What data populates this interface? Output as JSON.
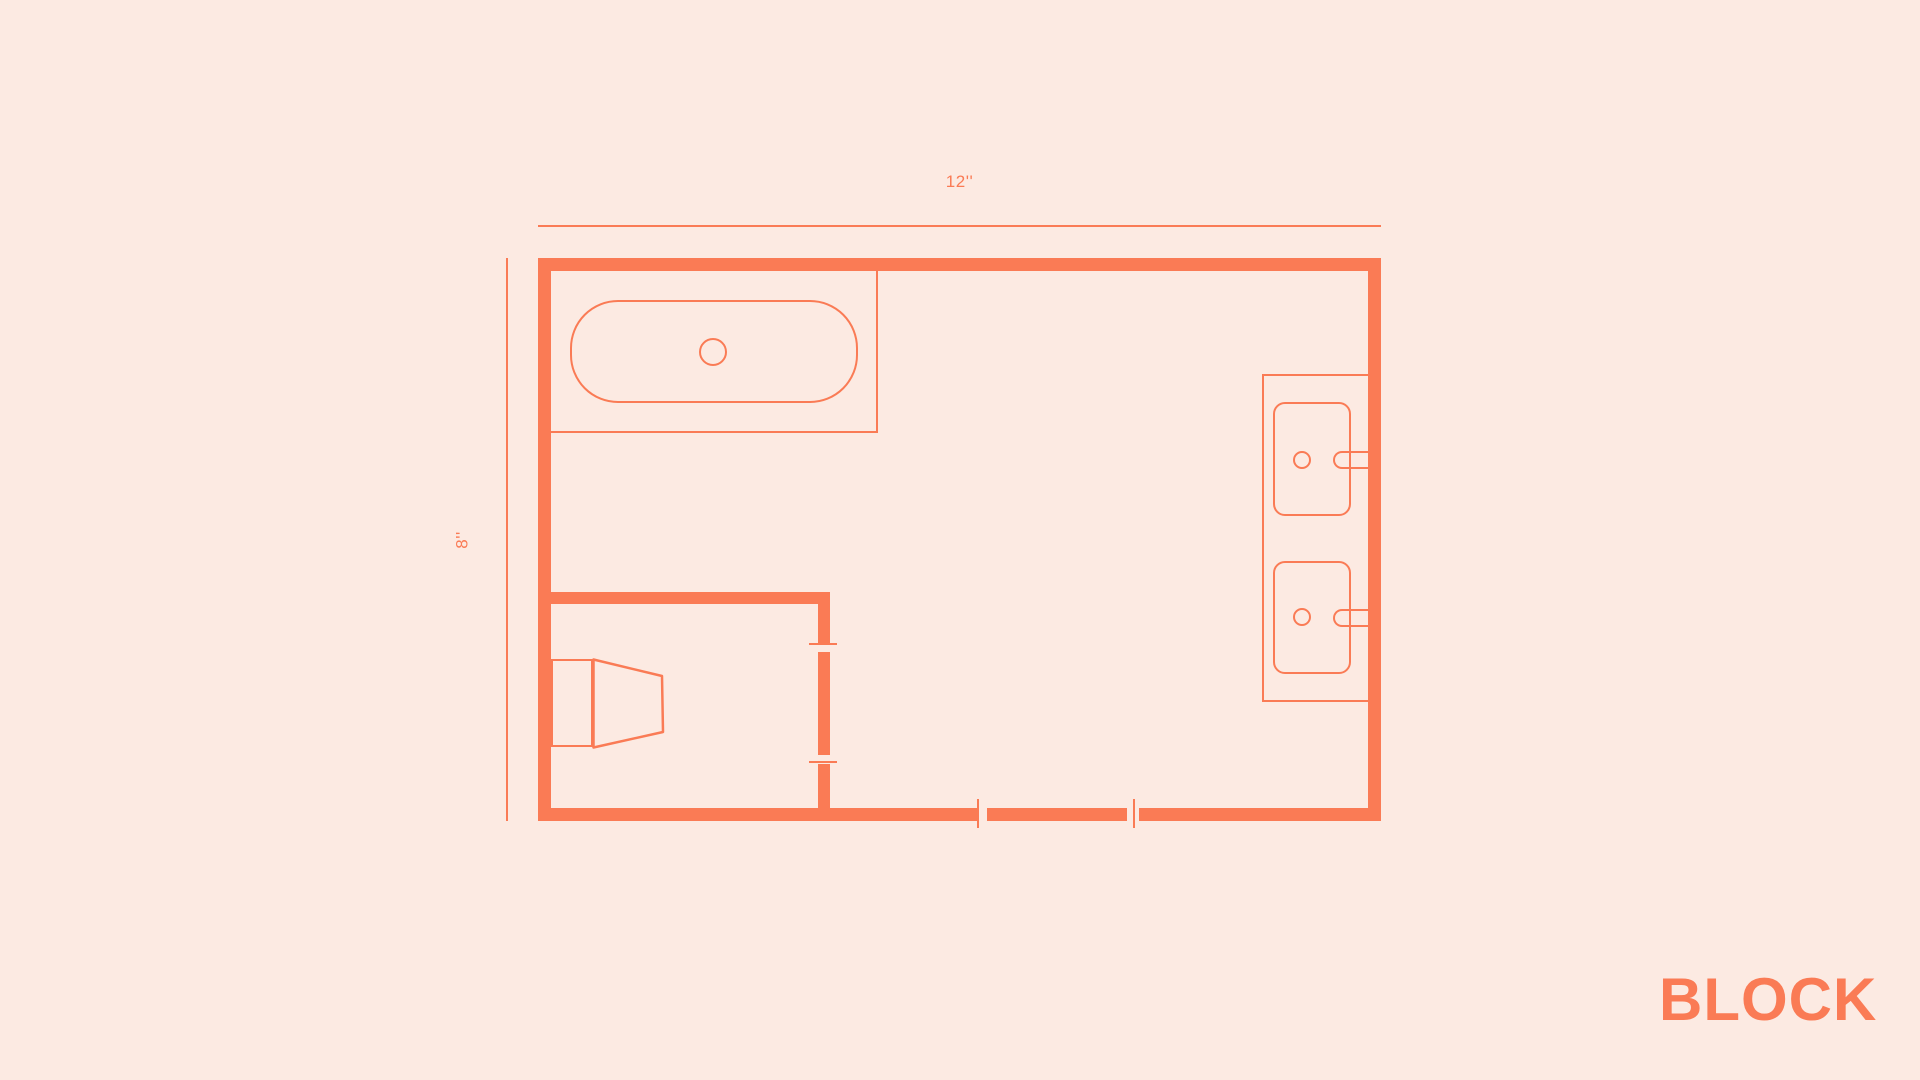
{
  "canvas": {
    "background_color": "#FCEAE2",
    "accent_color": "#FA7B55"
  },
  "floor_plan": {
    "top_dimension_label": "12''",
    "left_dimension_label": "8''",
    "fixtures": [
      {
        "id": "bathtub",
        "description": "bathtub with center drain in top-left alcove"
      },
      {
        "id": "toilet",
        "description": "toilet in bottom-left water closet"
      },
      {
        "id": "double-vanity",
        "description": "vanity on right wall with two sinks, drains and faucets"
      }
    ],
    "openings": [
      {
        "id": "entry-door",
        "description": "door opening in bottom wall"
      },
      {
        "id": "water-closet-door",
        "description": "door opening in interior partition wall"
      }
    ]
  },
  "branding": {
    "logo_text": "BLOCK"
  }
}
